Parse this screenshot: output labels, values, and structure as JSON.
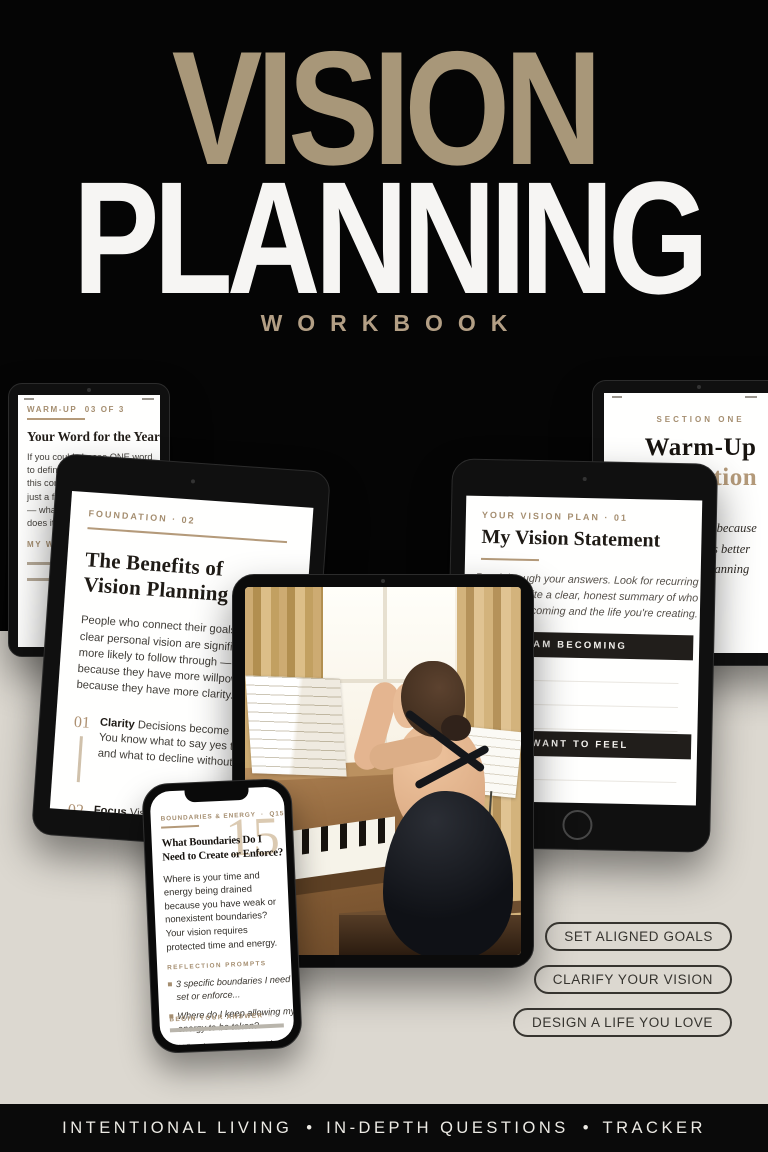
{
  "colors": {
    "accent_tan": "#A89779",
    "background_beige": "#DCD8D0",
    "background_black": "#050505",
    "bar_dark": "#211E1B",
    "big_number_tan": "#DBCAB2"
  },
  "header": {
    "title_line1": "VISION",
    "title_line2": "PLANNING",
    "subtitle": "WORKBOOK"
  },
  "warmup_tablet": {
    "eyebrow": "WARM-UP  03 OF 3",
    "heading": "Your Word for the Year",
    "body": "If you could choose ONE word\nto define your experience of\nthis coming year — not a goal,\njust a feeling or a theme\n— what would it be and why\ndoes it matter?",
    "answer_label": "MY WORD"
  },
  "foundation_tablet": {
    "eyebrow": "FOUNDATION · 02",
    "heading": "The Benefits of\nVision Planning",
    "body": "People who connect their goals to a\nclear personal vision are significantly\nmore likely to follow through — not\nbecause they have more willpower, but\nbecause they have more clarity.",
    "items": [
      {
        "num": "01",
        "lead": "Clarity",
        "text": " Decisions become easier.\nYou know what to say yes to\nand what to decline without guilt."
      },
      {
        "num": "02",
        "lead": "Focus",
        "text": " Vision reveals your ONE\nmost important priority. You stop\nchasing everything and start\nmastering what matters."
      }
    ]
  },
  "vision_tablet": {
    "eyebrow": "YOUR VISION PLAN · 01",
    "heading": "My Vision Statement",
    "body": "Read through your answers. Look for recurring\nthemes. Write a clear, honest summary of who\nyou're becoming and the life you're creating.",
    "bar1": "WHO I AM BECOMING",
    "bar2": "HOW I WANT TO FEEL"
  },
  "section_tablet": {
    "eyebrow": "SECTION ONE",
    "title_dark": "Warm-Up",
    "title_tan": "Reflection",
    "note": "Go slow here, because\nclarity comes better\nbefore the planning"
  },
  "photo": {
    "alt": "Woman in a black open-back dress seated at an upright piano beside a window with beige curtains and sheet music"
  },
  "phone": {
    "eyebrow": "BOUNDARIES & ENERGY  ·  Q15 OF 20",
    "big_number": "15",
    "heading": "What Boundaries Do I\nNeed to Create or Enforce?",
    "body": "Where is your time and\nenergy being drained\nbecause you have weak or\nnonexistent boundaries?\nYour vision requires\nprotected time and energy.",
    "prompts_label": "REFLECTION PROMPTS",
    "prompts": [
      "3 specific boundaries I need to\nset or enforce...",
      "Where do I keep allowing my\nenergy to be taken?",
      "What happens when I hold\nthese boundaries consistently?"
    ],
    "footer_label": "BEGIN YOUR ANSWER →"
  },
  "pills": [
    "SET ALIGNED GOALS",
    "CLARIFY YOUR VISION",
    "DESIGN A LIFE YOU LOVE"
  ],
  "bottom_bar": {
    "segment1": "INTENTIONAL LIVING",
    "bullet": "•",
    "segment2": "IN-DEPTH QUESTIONS",
    "segment3": "TRACKER"
  }
}
